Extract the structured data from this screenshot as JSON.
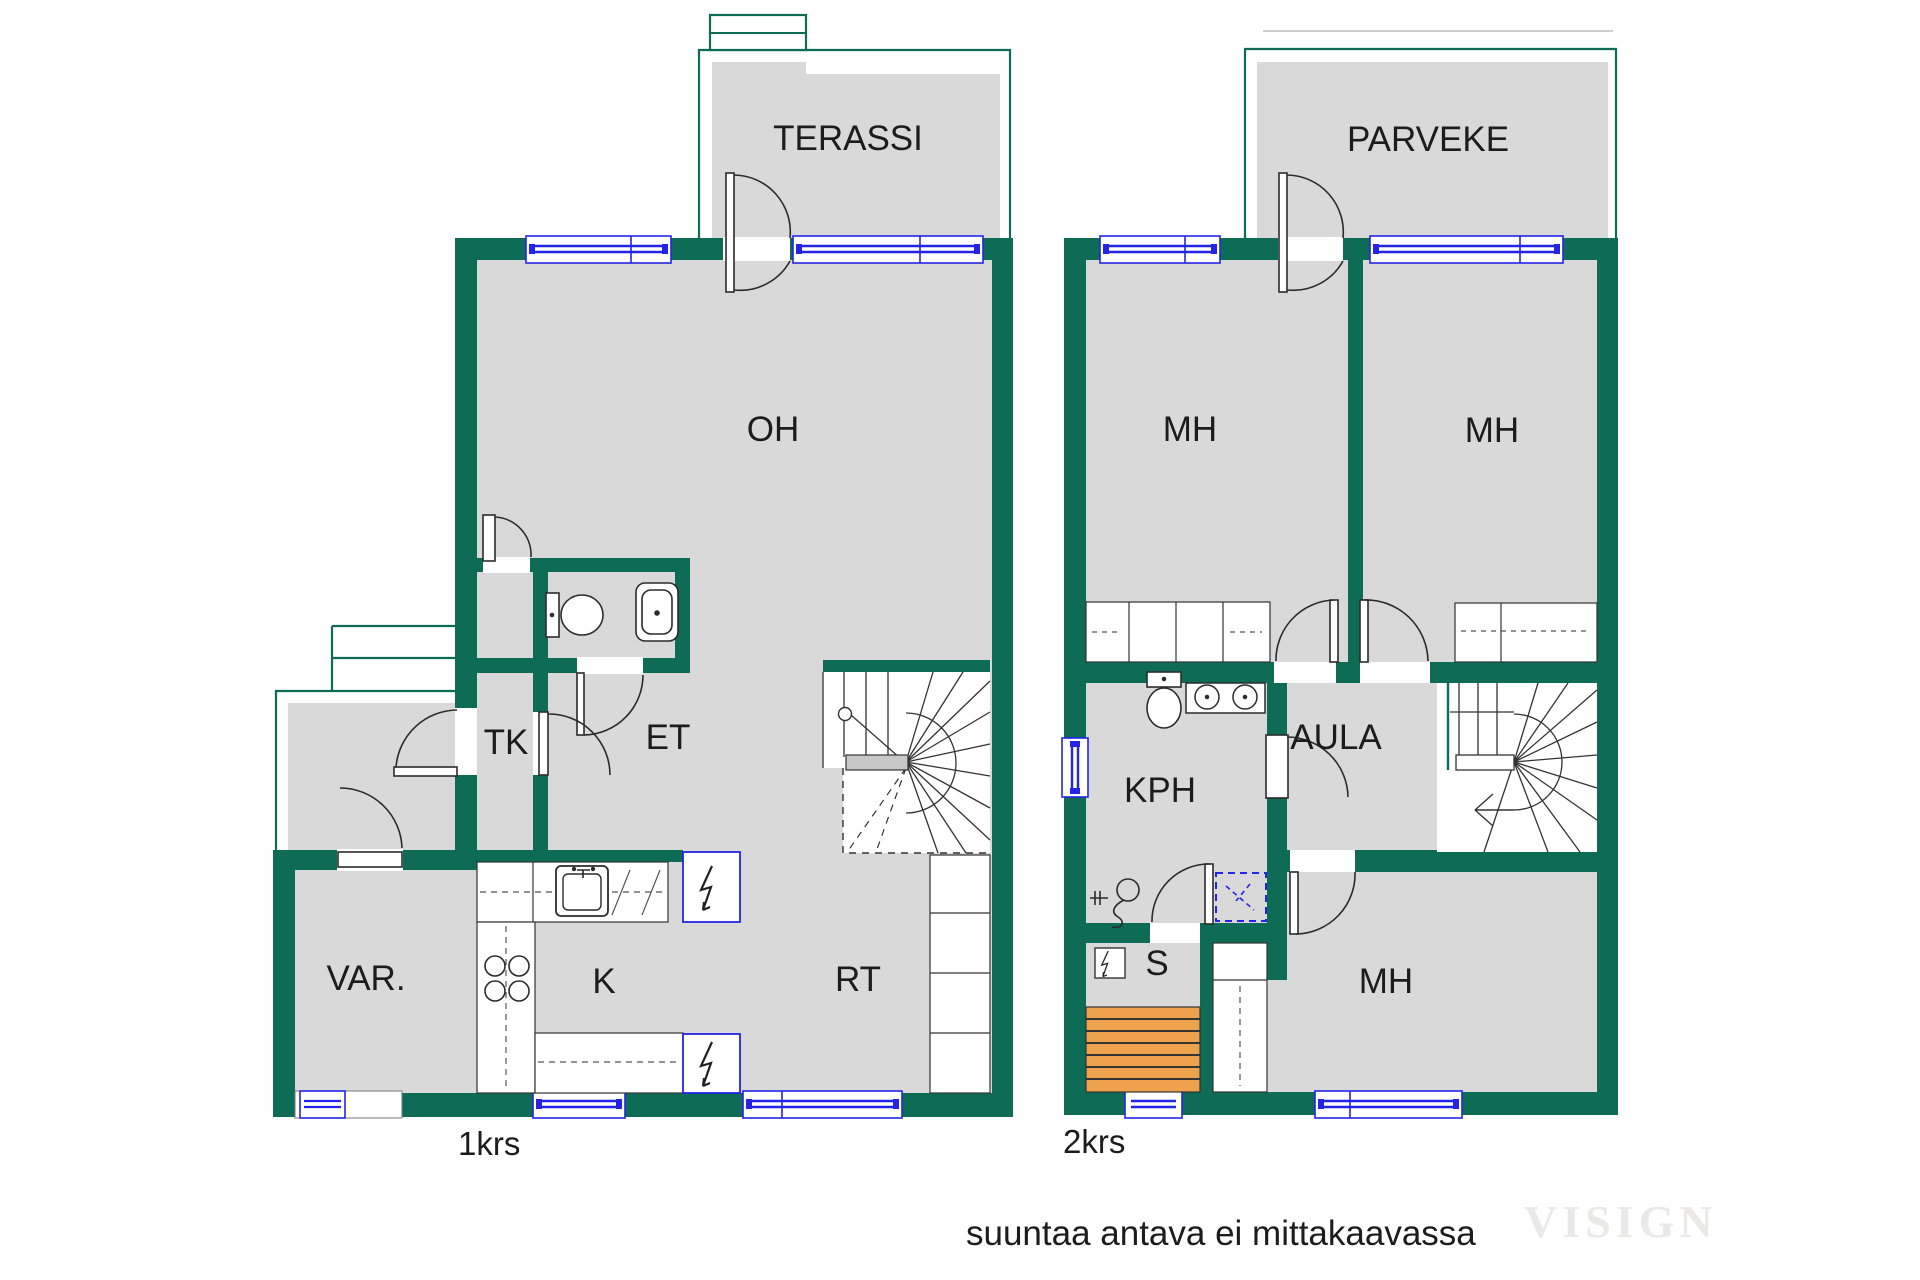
{
  "document": {
    "kind": "apartment floor plan",
    "language": "Finnish"
  },
  "colors": {
    "wall_green": "#0e6b55",
    "room_gray": "#d9d9d9",
    "window_blue": "#2424e8",
    "sauna_bench_orange": "#efa24c",
    "stair_landing_gray": "#c8c8c8",
    "watermark_gray": "#ebe8e8"
  },
  "icons": {
    "door": "door-swing-icon",
    "window": "window-icon",
    "stairs": "stairs-icon",
    "toilet": "toilet-icon",
    "sink": "sink-icon",
    "shower": "shower-icon",
    "washing_machine": "washing-machine-icon",
    "stove": "stove-icon",
    "appliance": "appliance-zigzag-icon",
    "sauna_heater": "sauna-heater-icon",
    "sauna_bench": "sauna-bench-icon",
    "wardrobe": "wardrobe-icon"
  },
  "floor1": {
    "caption": "1krs",
    "labels": {
      "terassi": "TERASSI",
      "oh": "OH",
      "tk": "TK",
      "et": "ET",
      "var": "VAR.",
      "k": "K",
      "rt": "RT"
    }
  },
  "floor2": {
    "caption": "2krs",
    "labels": {
      "parveke": "PARVEKE",
      "mh1": "MH",
      "mh2": "MH",
      "kph": "KPH",
      "aula": "AULA",
      "s": "S",
      "mh3": "MH"
    }
  },
  "footer": {
    "note": "suuntaa antava ei mittakaavassa",
    "watermark": "VISIGN"
  }
}
